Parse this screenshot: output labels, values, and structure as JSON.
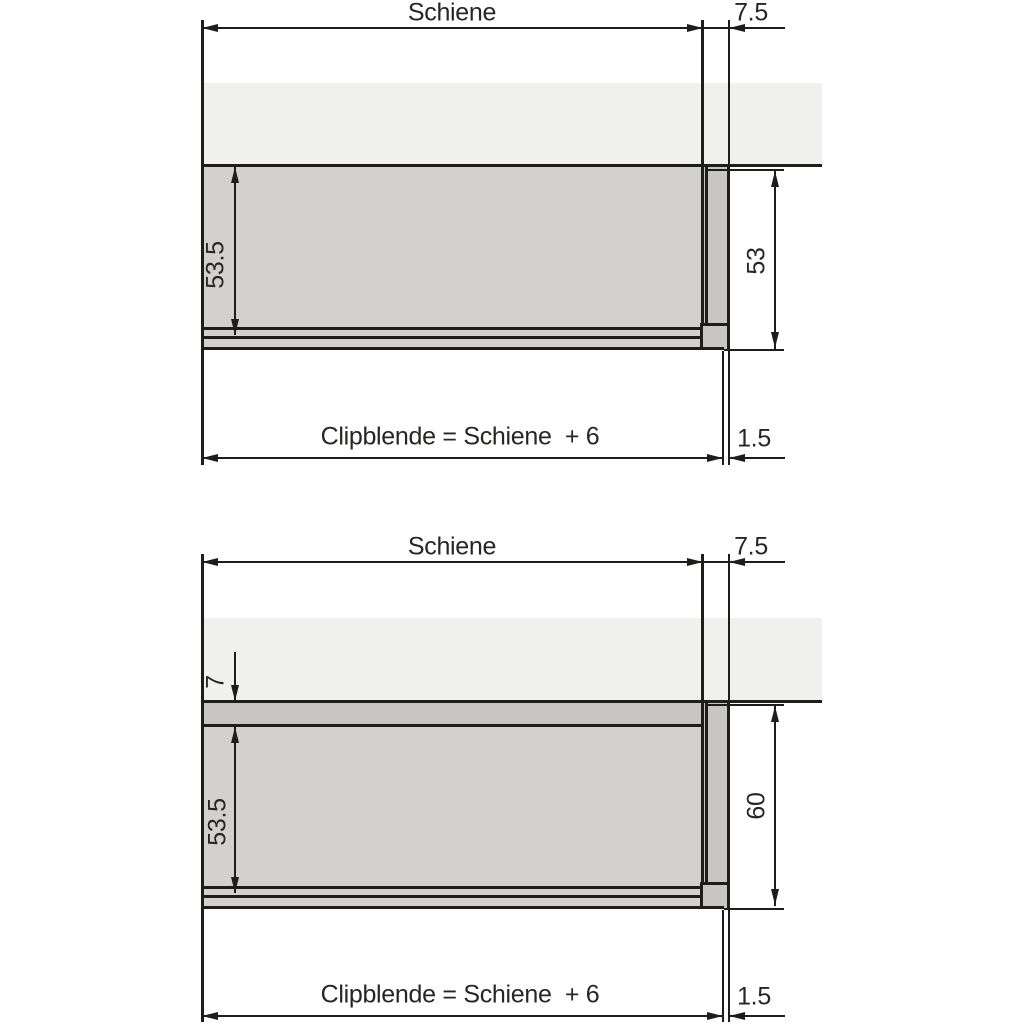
{
  "colors": {
    "line": "#1d1d1b",
    "panel": "#f0f0ee",
    "rail": "#d2d1cf",
    "clip": "#c7c6c4",
    "text": "#262624",
    "bg": "#ffffff"
  },
  "diagrams": {
    "top": {
      "schiene": "Schiene",
      "gap_right": "7.5",
      "rail_height": "53.5",
      "clip_height": "53",
      "formula": "Clipblende = Schiene  + 6",
      "thickness": "1.5"
    },
    "bottom": {
      "schiene": "Schiene",
      "gap_right": "7.5",
      "top_offset": "7",
      "rail_height": "53.5",
      "clip_height": "60",
      "formula": "Clipblende = Schiene  + 6",
      "thickness": "1.5"
    }
  }
}
